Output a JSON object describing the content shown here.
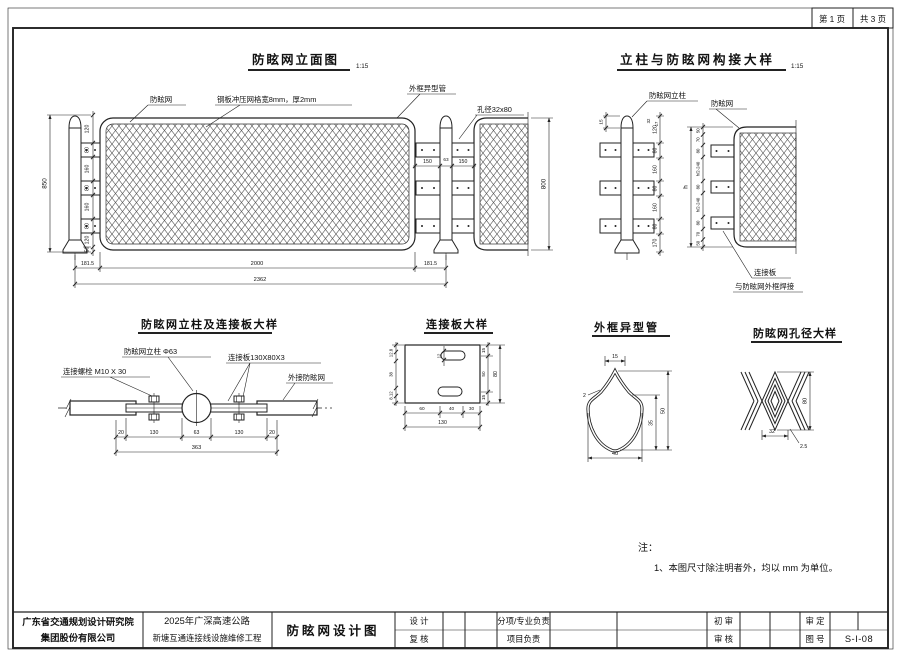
{
  "page": {
    "page_no": "第 1 页",
    "pages_total": "共 3 页"
  },
  "elevation": {
    "title": "防眩网立面图",
    "scale": "1:15",
    "labels": {
      "net": "防眩网",
      "mesh_spec": "钢板冲压网格宽8mm，厚2mm",
      "frame_tube": "外框异型管",
      "aperture": "孔径32x80"
    },
    "dims": {
      "left_chain": [
        "120",
        "80",
        "160",
        "80",
        "160",
        "80",
        "120",
        "50"
      ],
      "height": "850",
      "mid": [
        "150",
        "63",
        "150"
      ],
      "bottom": [
        "181.5",
        "2000",
        "181.5"
      ],
      "total_width": "2362",
      "panel_height": "800"
    }
  },
  "joint_detail": {
    "title": "立柱与防眩网构接大样",
    "scale": "1:15",
    "labels": {
      "post": "防眩网立柱",
      "net": "防眩网",
      "plate": "连接板",
      "weld": "与防眩网外框焊接"
    },
    "dims": {
      "cap": "15",
      "top_small": [
        "32",
        "17"
      ],
      "post_chain": [
        "120",
        "80",
        "160",
        "80",
        "160",
        "80",
        "170"
      ],
      "net_chain": [
        "50",
        "70",
        "80",
        "h/2-240",
        "80",
        "h/2-240",
        "80",
        "70",
        "50"
      ],
      "overall": "h"
    }
  },
  "post_plate_detail": {
    "title": "防眩网立柱及连接板大样",
    "labels": {
      "bolt": "连接螺栓 M10 X 30",
      "post": "防眩网立柱 Φ63",
      "plate": "连接板130X80X3",
      "net": "外接防眩网"
    },
    "dims": {
      "bottom": [
        "20",
        "130",
        "63",
        "130",
        "20"
      ],
      "total": "363"
    }
  },
  "plate_detail": {
    "title": "连接板大样",
    "dims": {
      "bottom": [
        "60",
        "40",
        "30"
      ],
      "width": "130",
      "right": [
        "15",
        "50",
        "15"
      ],
      "height": "80",
      "slot": "12",
      "left": [
        "12.8",
        "38",
        "8.12"
      ]
    }
  },
  "tube_detail": {
    "title": "外框异型管",
    "dims": {
      "top": "15",
      "thickness": "2",
      "bottom": "40",
      "height": "50",
      "mid": "35"
    }
  },
  "aperture_detail": {
    "title": "防眩网孔径大样",
    "dims": {
      "width": "32",
      "height": "80",
      "strand": "2.5"
    }
  },
  "note": {
    "head": "注：",
    "item1": "1、本图尺寸除注明者外，均以 mm 为单位。"
  },
  "title_block": {
    "company_line1": "广东省交通规划设计研究院",
    "company_line2": "集团股份有限公司",
    "project_line1": "2025年广深高速公路",
    "project_line2": "新塘互通连接线设施维修工程",
    "drawing_title": "防眩网设计图",
    "design": "设 计",
    "check": "复 核",
    "discipline": "分项/专业负责",
    "project_lead": "项目负责",
    "initial_review": "初 审",
    "review": "审 核",
    "approval": "审 定",
    "drawing_no_label": "图 号",
    "drawing_no": "S-I-08"
  }
}
